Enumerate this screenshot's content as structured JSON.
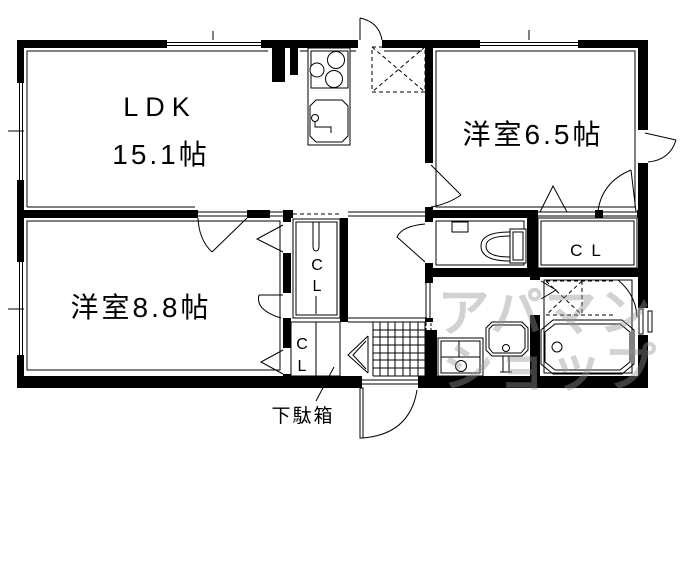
{
  "labels": {
    "ldk_line1": "LDK",
    "ldk_line2": "15.1帖",
    "room_65": "洋室6.5帖",
    "room_88": "洋室8.8帖",
    "closet": "CL",
    "closet_c": "C",
    "closet_l": "L",
    "getabako": "下駄箱"
  },
  "watermark": {
    "line1": "アパマン",
    "line2": "ショップ"
  },
  "fixtures": {
    "stove": "gas-stove-3-burner",
    "sink": "kitchen-sink",
    "fridge": "refrigerator-space",
    "toilet": "toilet",
    "washbasin": "washbasin",
    "washer": "washing-machine-space",
    "bathtub": "bathtub",
    "bath_door": "bath-folding-door",
    "genkan": "entrance-tiled-floor",
    "shoe_cabinet": "shoe-cabinet",
    "entrance_door": "entrance-door"
  },
  "colors": {
    "wall": "#000000",
    "background": "#ffffff",
    "watermark": "#8f9496"
  }
}
